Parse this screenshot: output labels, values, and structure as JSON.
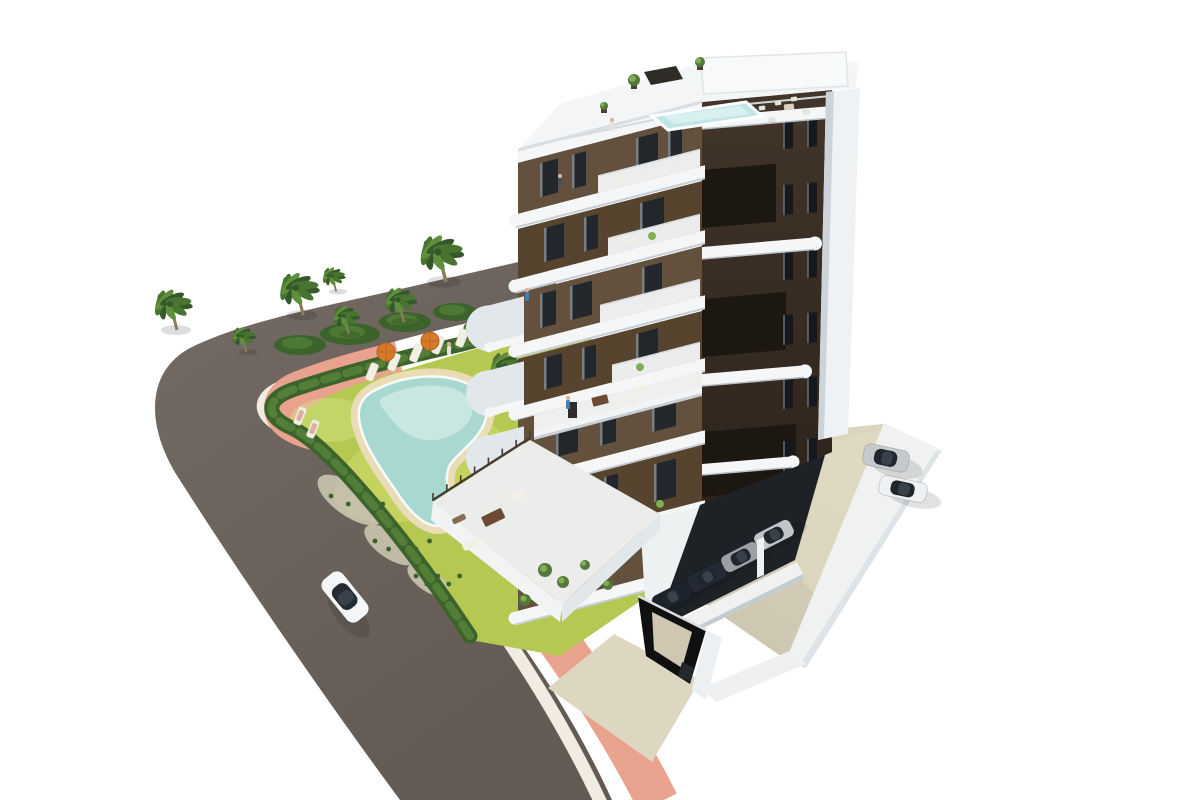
{
  "scene": {
    "kind": "aerial-architectural-render",
    "subject": "modern-apartment-building-with-pool-garden-road-and-parking",
    "width": 1200,
    "height": 800
  },
  "colors": {
    "background": "#ffffff",
    "asphalt": "#6e6560",
    "asphalt_dark": "#5f5750",
    "curb": "#f1ece1",
    "sidewalk": "#e9a28e",
    "lawn": "#b5c851",
    "lawn_light": "#cfdc6e",
    "hedge": "#3c632c",
    "hedge_light": "#537e37",
    "gravel": "#c8c2ad",
    "pool_deck": "#e9dcb6",
    "pool_water": "#a9d8d0",
    "pool_water_light": "#cdeae3",
    "waterline": "#f6fcf9",
    "palm_trunk": "#8d7b5f",
    "palm_dark": "#35582b",
    "palm_mid": "#49742f",
    "palm_light": "#5f8f3d",
    "umbrella": "#d67a2a",
    "lounger": "#f1efe6",
    "building_white": "#f3f5f6",
    "building_shade": "#e2e7eb",
    "slab": "#f4f6f7",
    "slab_shadow": "#c6ced4",
    "facade_brown": "#63503d",
    "facade_brown2": "#56442f",
    "facade_dark": "#3b2e22",
    "recess_black": "#1d1712",
    "window": "#23262a",
    "balcony_rail": "#f2f4f5",
    "roof_pool": "#bfe5e7",
    "roof_pool_light": "#d8f0f0",
    "pergola": "#2f2b26",
    "right_wall": "#eff2f4",
    "right_wall_shade": "#ccd4da",
    "parking_floor": "#d9d2bc",
    "parking_floor_shade": "#c3bca7",
    "deck_wall": "#f0f2f2",
    "deck_wall_shade": "#dde3e7",
    "covered_shadow": "#1e2227",
    "ramp_black": "#101010",
    "ramp_floor": "#cfc7b1",
    "driveway": "#ddd6c0",
    "terrace_floor": "#ecedea",
    "fence": "#473b2e",
    "furniture_brown": "#6d4a32",
    "furniture_white": "#f2efe7",
    "shrub": "#55793a",
    "shrub_light": "#7fae53",
    "person_blue": "#3f7fb5",
    "skin": "#d8b39a",
    "car_shadow": "rgba(0,0,0,0.25)"
  },
  "garden": {
    "palms": [
      {
        "x": 170,
        "y": 304,
        "s": 1.0
      },
      {
        "x": 242,
        "y": 336,
        "s": 0.62
      },
      {
        "x": 296,
        "y": 288,
        "s": 1.05
      },
      {
        "x": 344,
        "y": 316,
        "s": 0.7
      },
      {
        "x": 398,
        "y": 300,
        "s": 0.85
      },
      {
        "x": 438,
        "y": 252,
        "s": 1.15
      },
      {
        "x": 332,
        "y": 276,
        "s": 0.6
      },
      {
        "x": 470,
        "y": 330,
        "s": 0.5
      },
      {
        "x": 505,
        "y": 366,
        "s": 0.95
      }
    ],
    "bushes": [
      {
        "x": 300,
        "y": 345,
        "rx": 26,
        "ry": 10
      },
      {
        "x": 350,
        "y": 334,
        "rx": 30,
        "ry": 11
      },
      {
        "x": 405,
        "y": 322,
        "rx": 26,
        "ry": 10
      },
      {
        "x": 455,
        "y": 312,
        "rx": 22,
        "ry": 9
      },
      {
        "x": 505,
        "y": 318,
        "rx": 20,
        "ry": 9
      },
      {
        "x": 520,
        "y": 330,
        "rx": 14,
        "ry": 7
      }
    ],
    "loungers": [
      {
        "x": 372,
        "y": 372
      },
      {
        "x": 394,
        "y": 362
      },
      {
        "x": 416,
        "y": 353
      },
      {
        "x": 438,
        "y": 345
      },
      {
        "x": 462,
        "y": 338
      },
      {
        "x": 300,
        "y": 416,
        "sunbather": true
      },
      {
        "x": 313,
        "y": 429,
        "sunbather": true
      }
    ],
    "umbrellas": [
      {
        "x": 386,
        "y": 352
      },
      {
        "x": 430,
        "y": 341
      }
    ],
    "gravel_patches": [
      {
        "x": 350,
        "y": 500,
        "rx": 38,
        "ry": 16
      },
      {
        "x": 390,
        "y": 545,
        "rx": 30,
        "ry": 13
      },
      {
        "x": 428,
        "y": 580,
        "rx": 24,
        "ry": 11
      }
    ]
  },
  "building": {
    "floors_left": [
      {
        "top": 115,
        "bot": 166,
        "shade": 0,
        "wins": [
          [
            540,
            18,
            34
          ],
          [
            572,
            14,
            34
          ],
          [
            636,
            22,
            34
          ],
          [
            668,
            14,
            34
          ]
        ],
        "balc": [
          598,
          700
        ],
        "plant": null
      },
      {
        "top": 181,
        "bot": 231,
        "shade": 1,
        "wins": [
          [
            544,
            20,
            34
          ],
          [
            584,
            14,
            34
          ],
          [
            640,
            24,
            34
          ]
        ],
        "balc": [
          608,
          700
        ],
        "plant": 652
      },
      {
        "top": 246,
        "bot": 296,
        "shade": 0,
        "wins": [
          [
            540,
            16,
            34
          ],
          [
            570,
            22,
            34
          ],
          [
            642,
            20,
            34
          ]
        ],
        "balc": [
          600,
          700
        ],
        "plant": null
      },
      {
        "top": 311,
        "bot": 359,
        "shade": 1,
        "wins": [
          [
            544,
            18,
            32
          ],
          [
            582,
            14,
            32
          ],
          [
            636,
            22,
            32
          ]
        ],
        "balc": [
          612,
          700
        ],
        "plant": 640
      },
      {
        "top": 372,
        "bot": 431,
        "shade": 0,
        "wins": [
          [
            556,
            22,
            40
          ],
          [
            600,
            16,
            40
          ],
          [
            652,
            24,
            40
          ]
        ],
        "balc": null,
        "plant": null
      },
      {
        "top": 445,
        "bot": 501,
        "shade": 1,
        "wins": [
          [
            560,
            20,
            38
          ],
          [
            604,
            14,
            38
          ],
          [
            654,
            22,
            38
          ]
        ],
        "balc": null,
        "plant": 660
      },
      {
        "top": 515,
        "bot": 563,
        "shade": 0,
        "wins": [
          [
            566,
            22,
            36
          ],
          [
            648,
            20,
            36
          ]
        ],
        "balc": null,
        "plant": null
      }
    ],
    "side_balconies": [
      {
        "top": 250,
        "bot": 296
      },
      {
        "top": 315,
        "bot": 361
      },
      {
        "top": 380,
        "bot": 426
      }
    ],
    "right_bands": [
      {
        "y": 117,
        "x2": 830,
        "h": 12,
        "cap": false
      },
      {
        "y": 247,
        "x2": 814,
        "h": 12,
        "cap": true
      },
      {
        "y": 374,
        "x2": 804,
        "h": 12,
        "cap": true
      },
      {
        "y": 464,
        "x2": 792,
        "h": 11,
        "cap": true
      }
    ],
    "right_recesses": [
      {
        "y1": 170,
        "y2": 228,
        "x2": 776
      },
      {
        "y1": 299,
        "y2": 357,
        "x2": 786
      },
      {
        "y1": 432,
        "y2": 497,
        "x2": 796
      }
    ],
    "right_window_floors": [
      126,
      192,
      257,
      322,
      386,
      448
    ],
    "roof_furniture": [
      {
        "x": 762,
        "y": 108
      },
      {
        "x": 778,
        "y": 103
      },
      {
        "x": 794,
        "y": 99
      },
      {
        "x": 806,
        "y": 112
      },
      {
        "x": 772,
        "y": 120
      }
    ],
    "roof_plants": [
      {
        "x": 634,
        "y": 80,
        "r": 6
      },
      {
        "x": 700,
        "y": 62,
        "r": 5
      },
      {
        "x": 604,
        "y": 106,
        "r": 4
      }
    ]
  },
  "parking": {
    "covered_cars": [
      {
        "x": 672,
        "y": 597,
        "c": "#1d232c"
      },
      {
        "x": 707,
        "y": 577,
        "c": "#232a35"
      },
      {
        "x": 741,
        "y": 557,
        "c": "#9aa0a6"
      },
      {
        "x": 774,
        "y": 535,
        "c": "#c2c6ca"
      }
    ],
    "open_cars": [
      {
        "x": 886,
        "y": 458,
        "c": "#c6cacd",
        "rot": 12,
        "len": 46,
        "wid": 22
      },
      {
        "x": 903,
        "y": 489,
        "c": "#eef0f1",
        "rot": 12,
        "len": 48,
        "wid": 20
      }
    ]
  },
  "road_car": {
    "x": 345,
    "y": 597,
    "rot": 51,
    "body": "#f5f6f7",
    "glass": "#262b31",
    "len": 54,
    "wid": 26
  },
  "people": [
    {
      "x": 612,
      "y": 126,
      "c": "#e4e4e2"
    },
    {
      "x": 568,
      "y": 404,
      "c": "#3f7fb5"
    },
    {
      "x": 527,
      "y": 296,
      "c": "#3f7fb5"
    },
    {
      "x": 560,
      "y": 182,
      "c": "#4a4f57"
    },
    {
      "x": 449,
      "y": 350,
      "c": "#e8e4da"
    }
  ]
}
